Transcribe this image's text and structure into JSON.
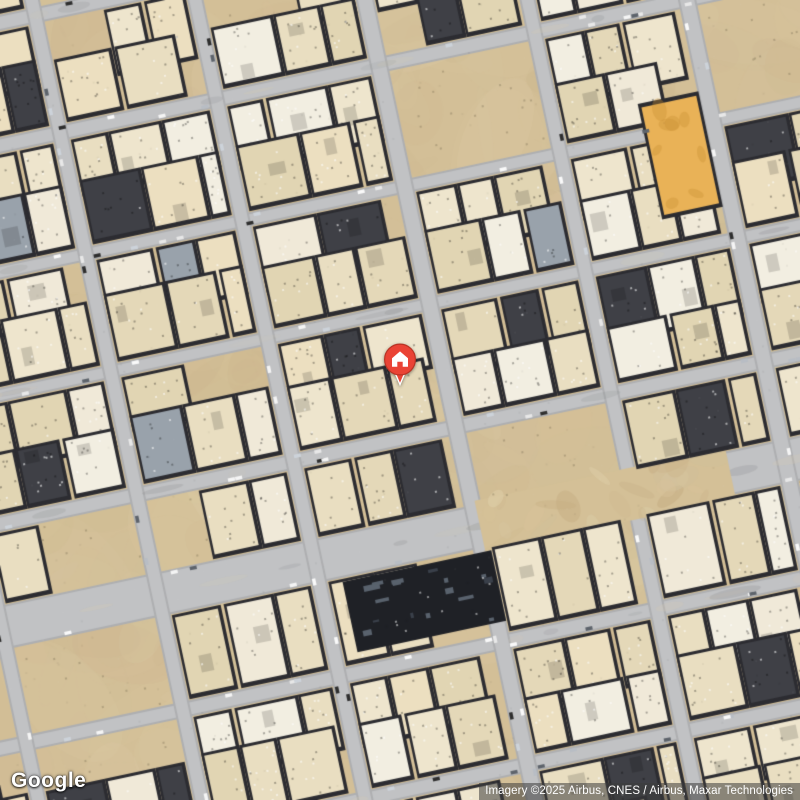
{
  "map": {
    "imagery_type": "satellite",
    "marker": {
      "label": "home",
      "x": 400,
      "y": 360
    }
  },
  "branding": {
    "google_logo": "Google"
  },
  "attribution": {
    "text": "Imagery ©2025 Airbus, CNES / Airbus, Maxar Technologies"
  },
  "palette": {
    "sand": "#d3bf97",
    "road_base": "#aeafb1",
    "road_light": "#c1c2c4",
    "building_shadow": "#2c2c31",
    "marker_red": "#EA4335",
    "marker_red_dark": "#b93425",
    "orange_building": "#e9b257"
  }
}
